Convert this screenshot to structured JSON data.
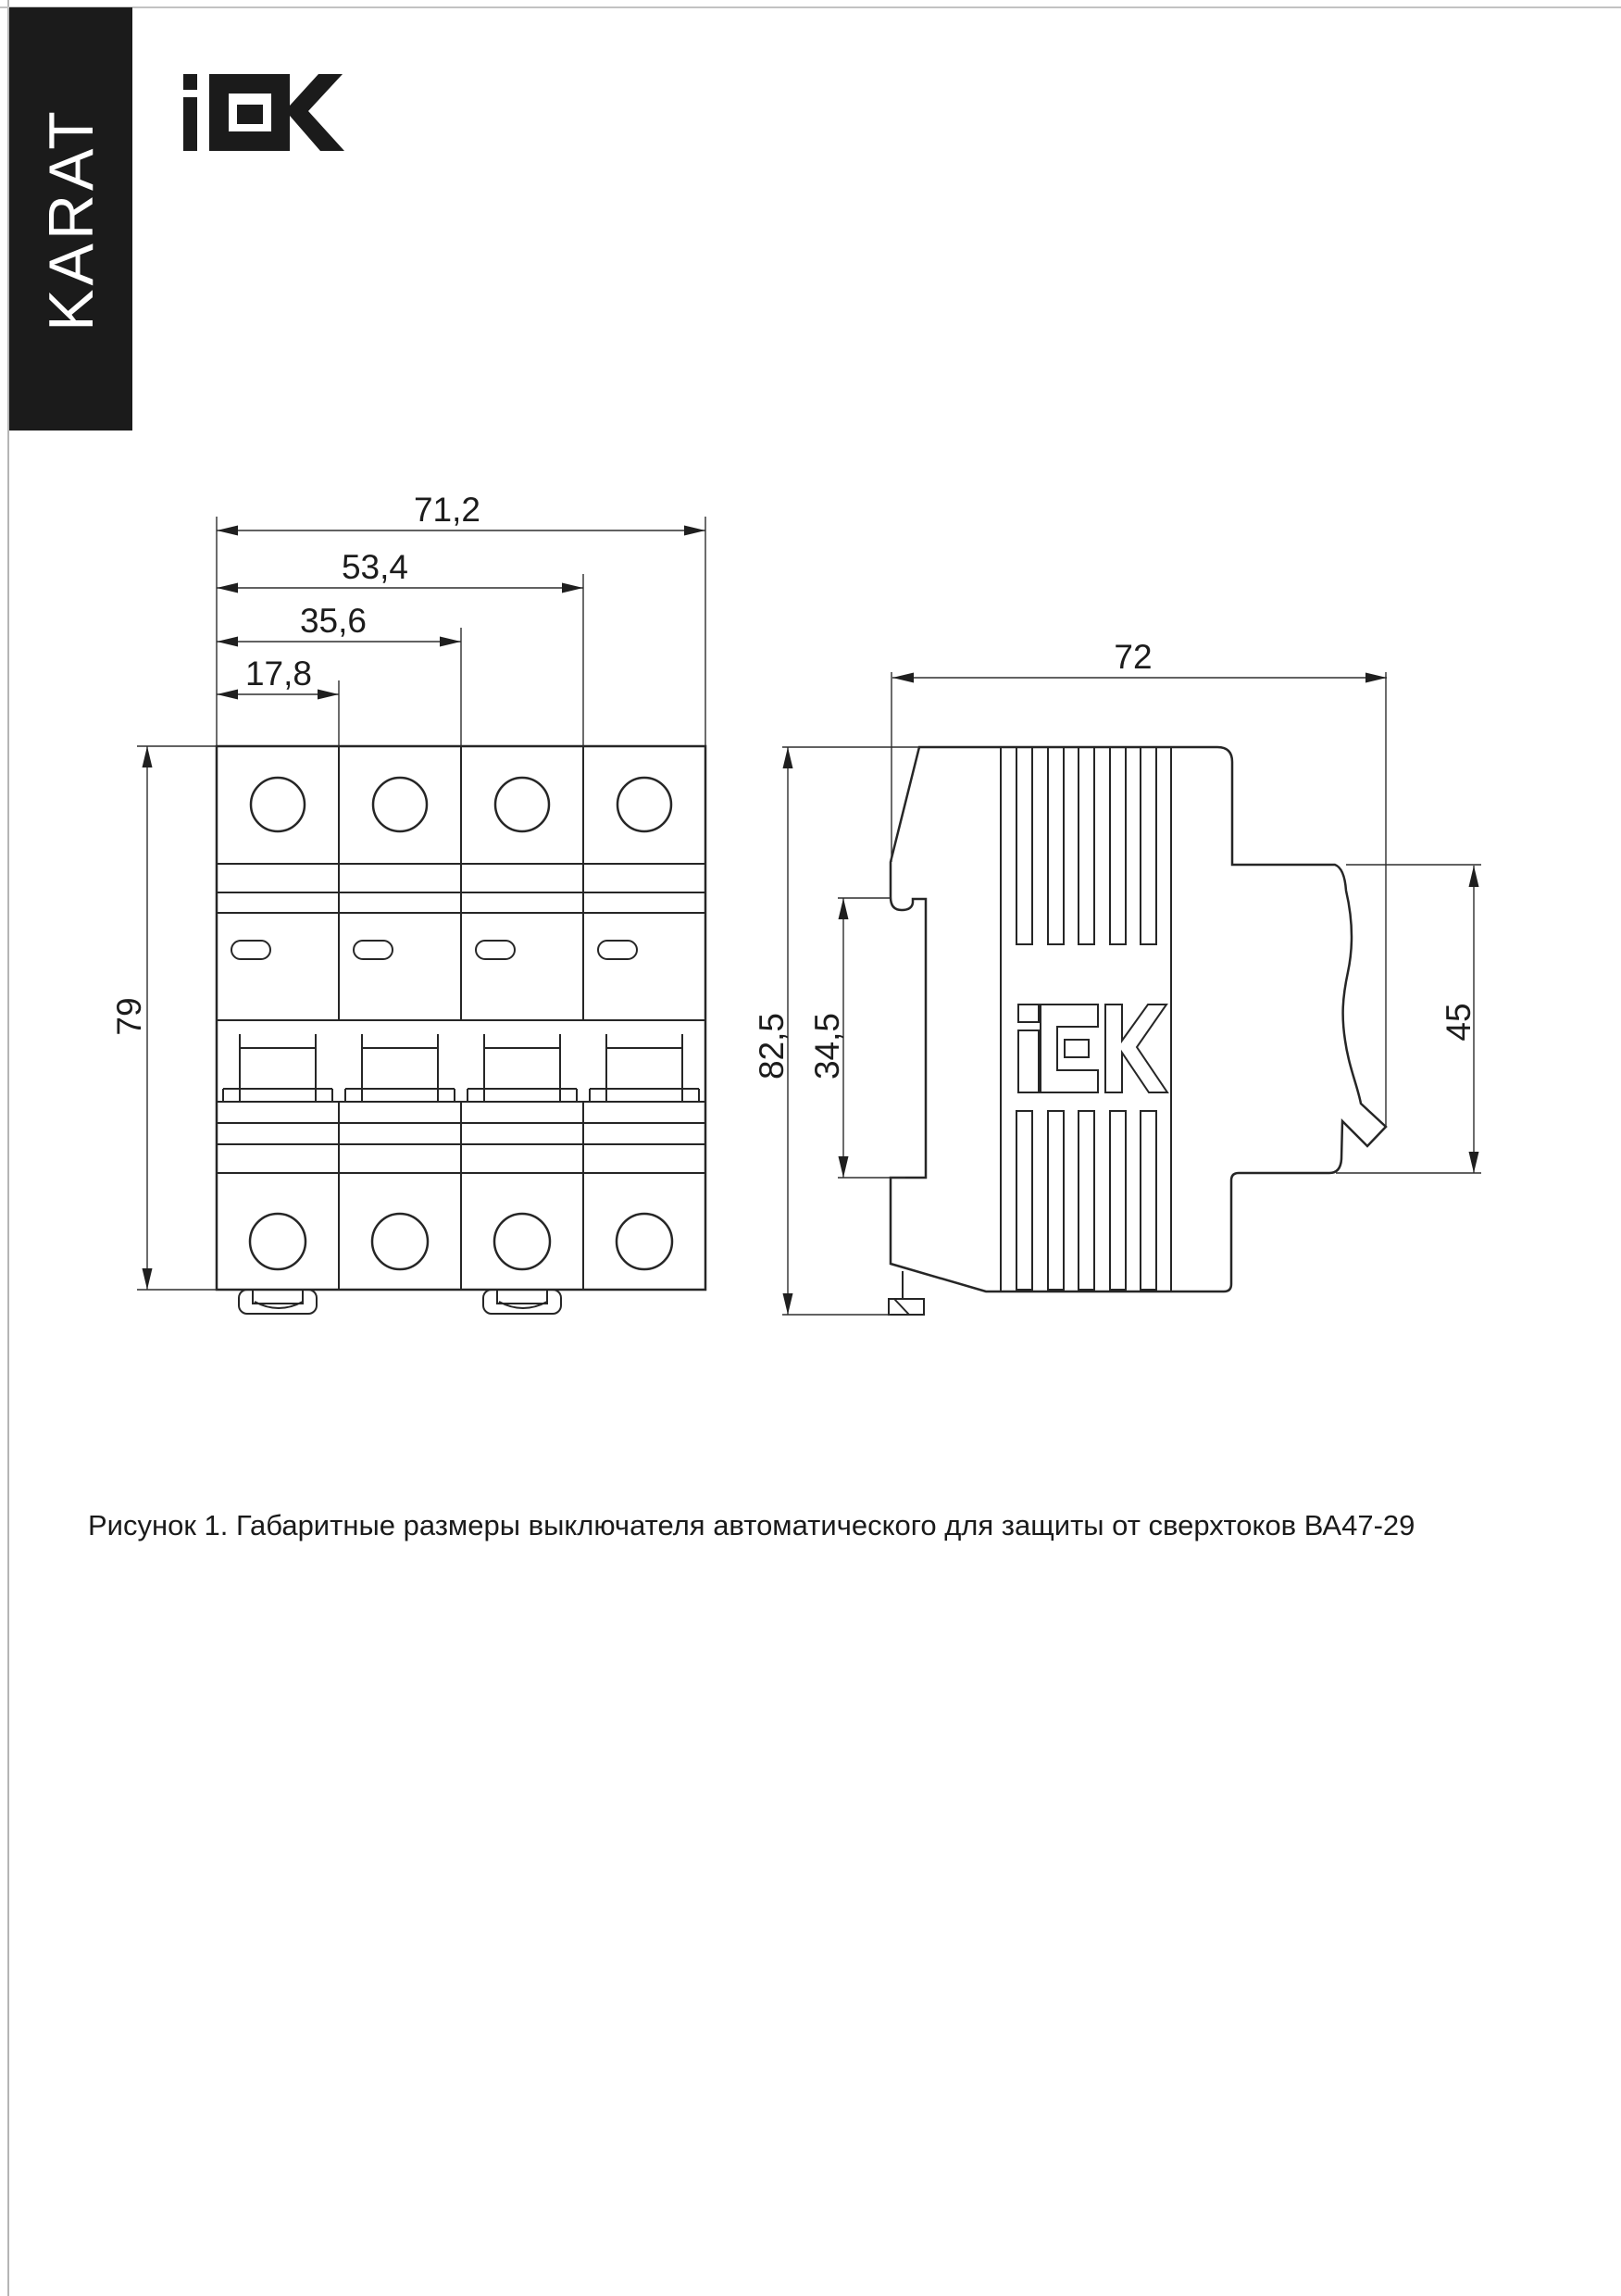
{
  "page": {
    "caption": "Рисунок 1. Габаритные размеры выключателя автоматического для защиты от сверхтоков ВА47-29"
  },
  "branding": {
    "banner_text": "KARAT",
    "logo_name": "IEK"
  },
  "drawing": {
    "front_view": {
      "dims": {
        "total_width": "71,2",
        "width_3p": "53,4",
        "width_2p": "35,6",
        "width_1p": "17,8",
        "height": "79"
      }
    },
    "side_view": {
      "dims": {
        "depth": "72",
        "total_height": "82,5",
        "din_clip_span": "34,5",
        "front_height": "45"
      }
    }
  },
  "colors": {
    "ink": "#262626",
    "banner_bg": "#1b1b1b",
    "paper": "#ffffff"
  }
}
